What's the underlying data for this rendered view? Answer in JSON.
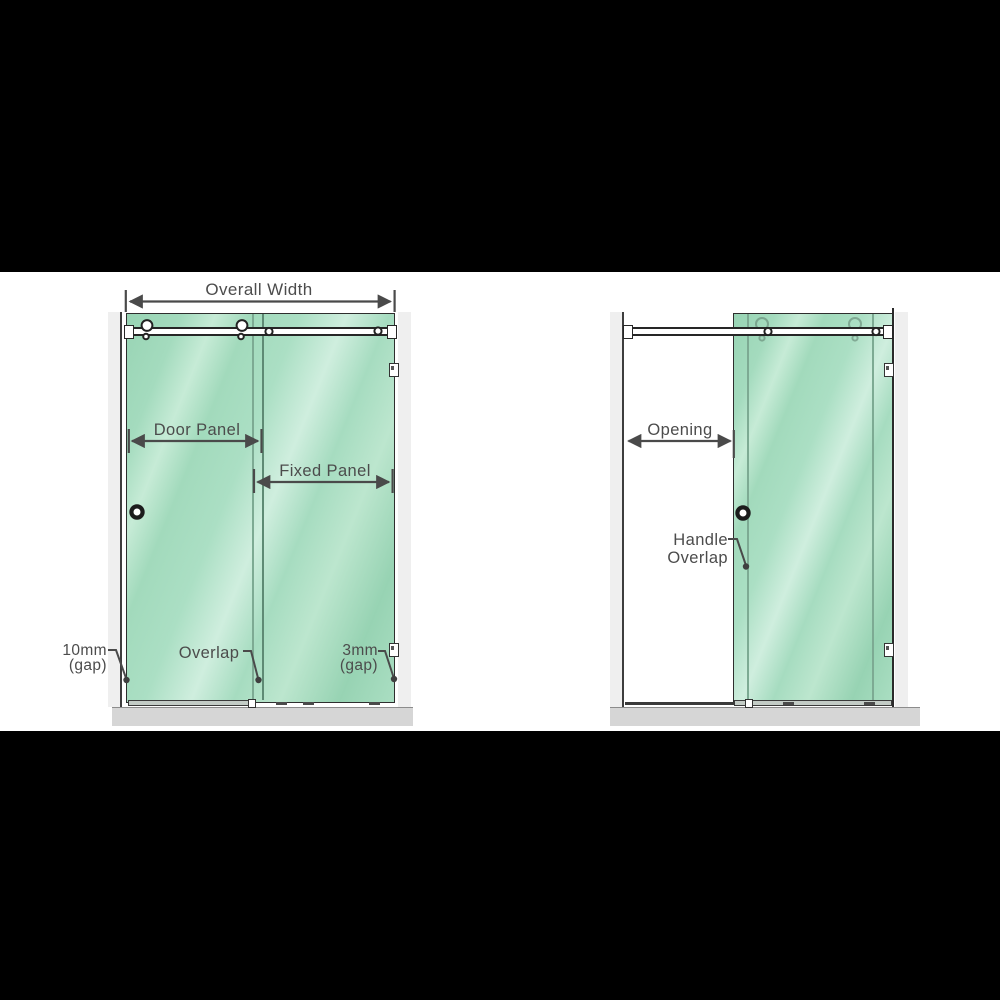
{
  "left_diagram": {
    "overall_width": "Overall Width",
    "door_panel": "Door Panel",
    "fixed_panel": "Fixed Panel",
    "gap_left": {
      "line1": "10mm",
      "line2": "(gap)"
    },
    "overlap": "Overlap",
    "gap_right": {
      "line1": "3mm",
      "line2": "(gap)"
    }
  },
  "right_diagram": {
    "opening": "Opening",
    "handle_overlap": {
      "line1": "Handle",
      "line2": "Overlap"
    }
  },
  "colors": {
    "glass_green": "#a6dcc0",
    "glass_highlight": "#cfeede",
    "outline_dark": "#2e2e2e",
    "dimension_gray": "#4a4a4a",
    "floor_gray": "#d6d6d6",
    "wall_gray": "#efefef",
    "letterbox_black": "#000000"
  }
}
